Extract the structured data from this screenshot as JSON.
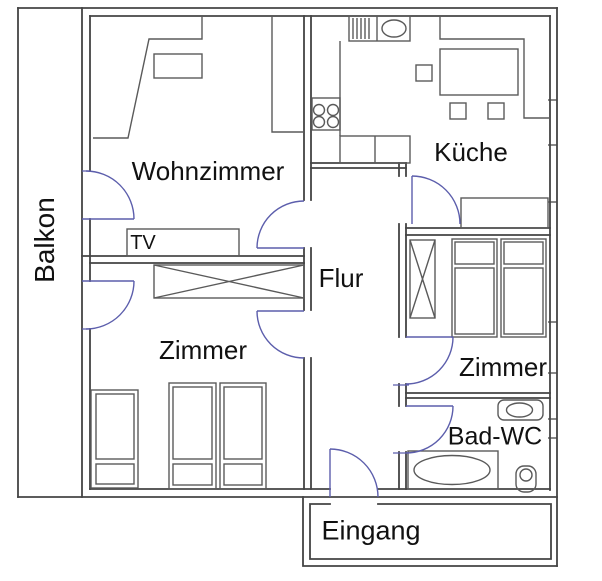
{
  "floorplan": {
    "rooms": {
      "balkon": {
        "label": "Balkon"
      },
      "wohnzimmer": {
        "label": "Wohnzimmer"
      },
      "kueche": {
        "label": "Küche"
      },
      "flur": {
        "label": "Flur"
      },
      "zimmer_links": {
        "label": "Zimmer"
      },
      "zimmer_rechts": {
        "label": "Zimmer"
      },
      "bad_wc": {
        "label": "Bad-WC"
      },
      "eingang": {
        "label": "Eingang"
      }
    },
    "furniture": {
      "tv_label": "TV"
    },
    "colors": {
      "wall": "#444444",
      "furniture": "#5a5a5a",
      "door_swing": "#5c5eac",
      "label_text": "#111111",
      "background": "#ffffff"
    }
  }
}
